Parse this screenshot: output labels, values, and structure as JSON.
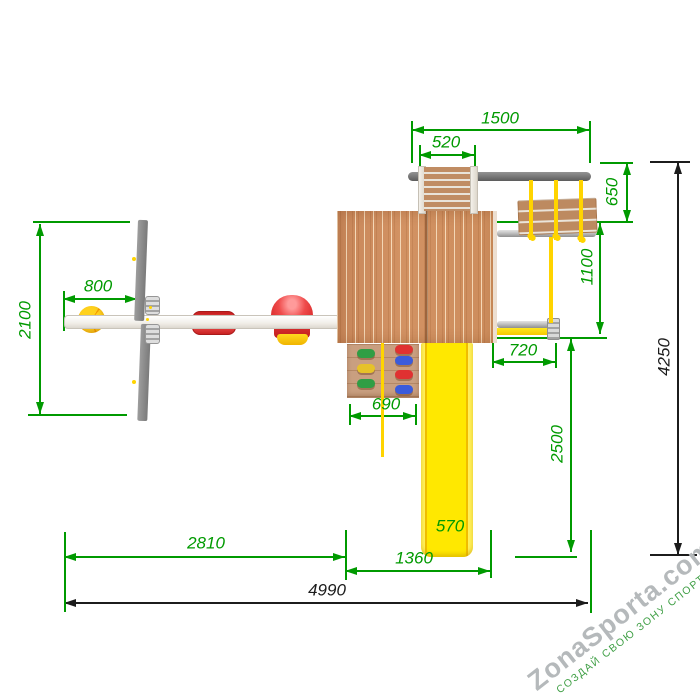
{
  "dims": {
    "d1500": "1500",
    "d520": "520",
    "d650": "650",
    "d1100": "1100",
    "d800": "800",
    "d2100": "2100",
    "d720": "720",
    "d690": "690",
    "d2500": "2500",
    "d570": "570",
    "d1360": "1360",
    "d2810": "2810",
    "d4990": "4990",
    "d4250": "4250"
  },
  "watermark": {
    "brand": "ZonaSporta.com",
    "slogan": "СОЗДАЙ СВОЮ ЗОНУ СПОРТА"
  },
  "colors": {
    "dimension_green": "#009a00",
    "dimension_black": "#1c1c1c",
    "wood": "#cd8d5c",
    "slide_yellow": "#ffe800",
    "rope_yellow": "#ffd400",
    "seat_red": "#e03131",
    "beam_dark": "#6f6f6f",
    "beam_light": "#c6c6c6",
    "watermark_gray": "#b5b9bb",
    "watermark_green": "#3f9f45"
  }
}
